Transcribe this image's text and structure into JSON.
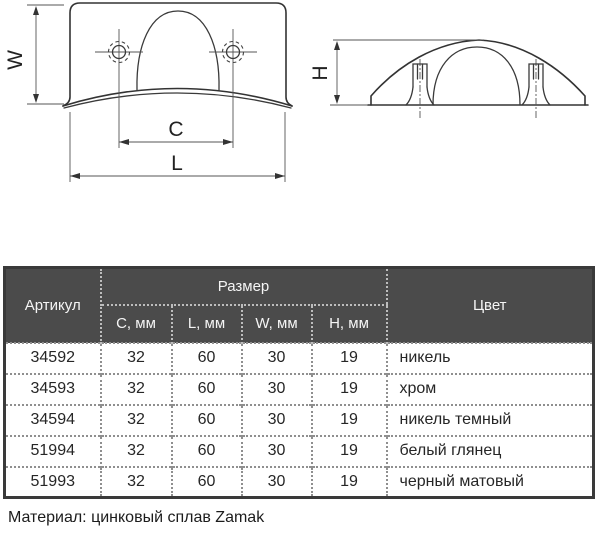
{
  "drawing": {
    "dim_labels": {
      "w": "W",
      "c": "C",
      "l": "L",
      "h": "H"
    }
  },
  "table": {
    "header": {
      "article": "Артикул",
      "size_group": "Размер",
      "size_columns": [
        "C, мм",
        "L, мм",
        "W, мм",
        "H, мм"
      ],
      "color": "Цвет"
    },
    "rows": [
      {
        "article": "34592",
        "c": "32",
        "l": "60",
        "w": "30",
        "h": "19",
        "color": "никель"
      },
      {
        "article": "34593",
        "c": "32",
        "l": "60",
        "w": "30",
        "h": "19",
        "color": "хром"
      },
      {
        "article": "34594",
        "c": "32",
        "l": "60",
        "w": "30",
        "h": "19",
        "color": "никель темный"
      },
      {
        "article": "51994",
        "c": "32",
        "l": "60",
        "w": "30",
        "h": "19",
        "color": "белый глянец"
      },
      {
        "article": "51993",
        "c": "32",
        "l": "60",
        "w": "30",
        "h": "19",
        "color": "черный матовый"
      }
    ]
  },
  "footer": {
    "material_note": "Материал: цинковый сплав Zamak"
  },
  "colors": {
    "header_bg": "#4b4b4b",
    "header_text": "#f5f5f5",
    "table_border": "#3a3a3a",
    "header_divider": "#bdbdbd",
    "body_divider": "#8f8f8f",
    "drawing_line": "#333333"
  }
}
